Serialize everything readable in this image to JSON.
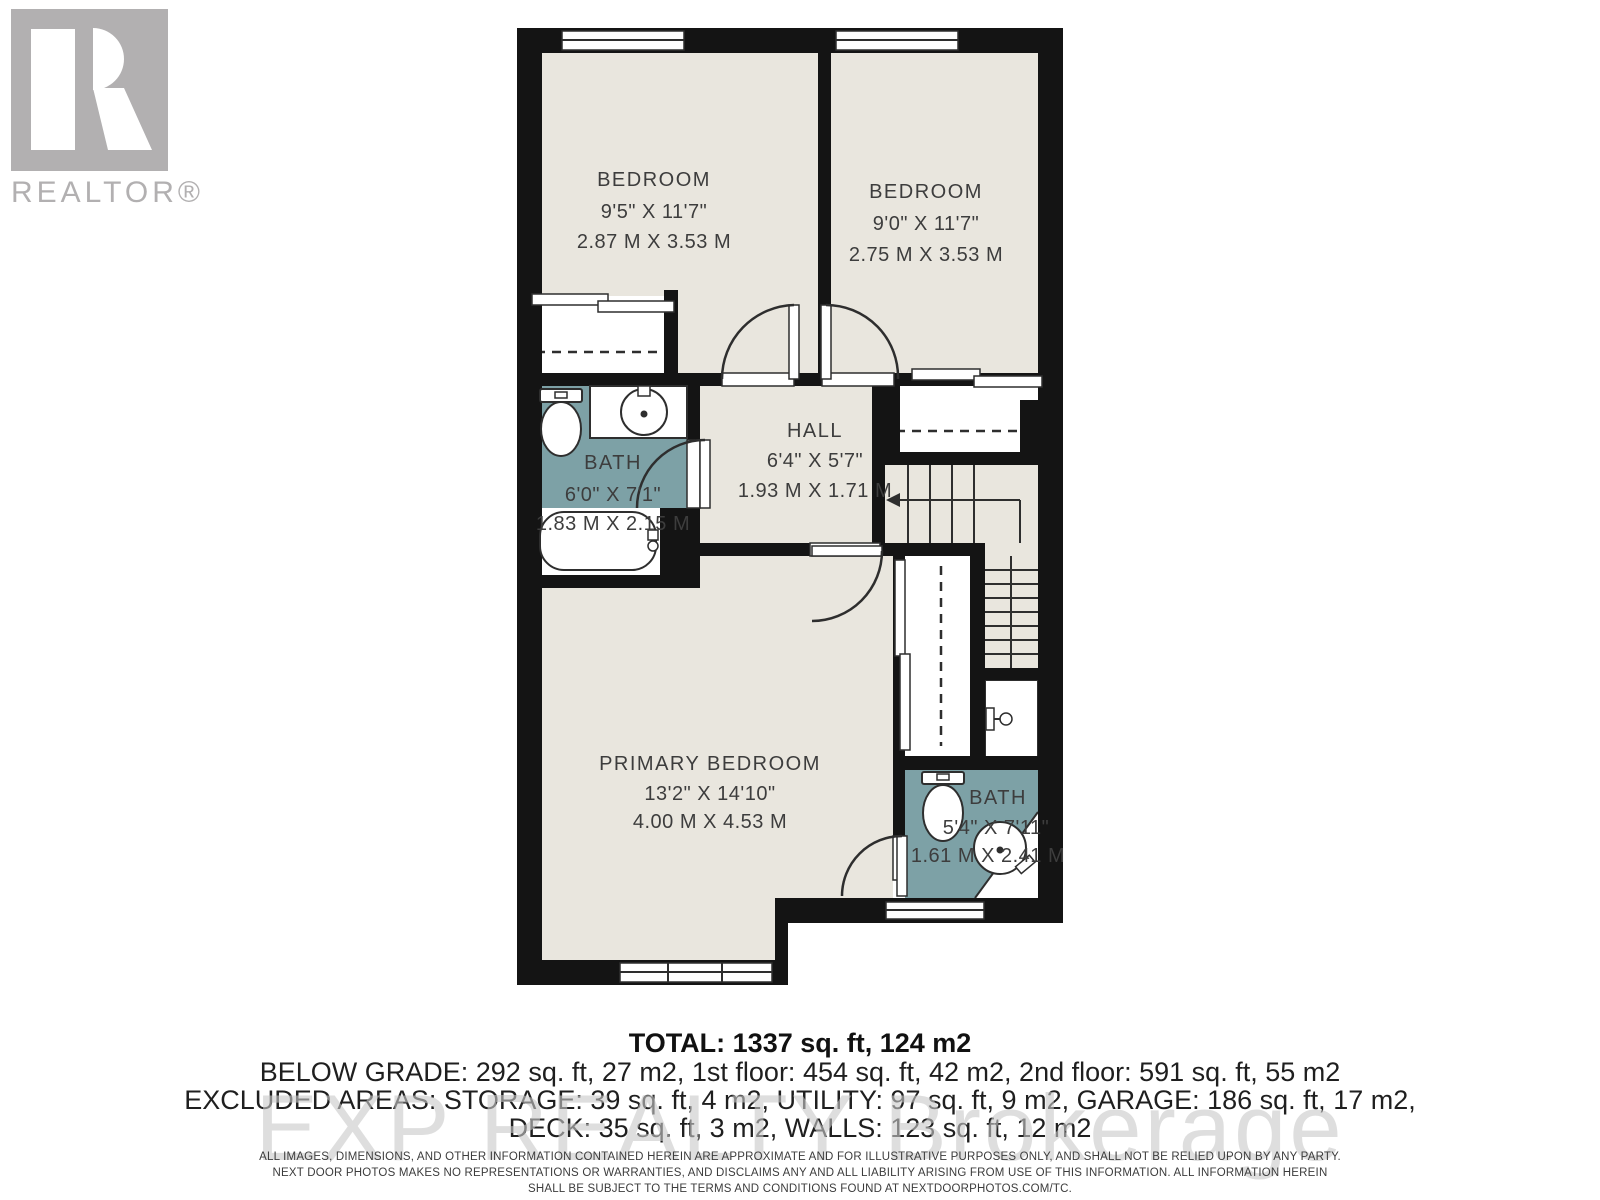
{
  "logo": {
    "symbol": "realtor-block-r",
    "wordmark": "REALTOR®"
  },
  "plan": {
    "rooms": {
      "bedroom1": {
        "name": "BEDROOM",
        "dims_imperial": "9'5\" X 11'7\"",
        "dims_metric": "2.87 M X 3.53 M"
      },
      "bedroom2": {
        "name": "BEDROOM",
        "dims_imperial": "9'0\" X 11'7\"",
        "dims_metric": "2.75 M X 3.53 M"
      },
      "hall": {
        "name": "HALL",
        "dims_imperial": "6'4\" X 5'7\"",
        "dims_metric": "1.93 M X 1.71 M"
      },
      "bath1": {
        "name": "BATH",
        "dims_imperial": "6'0\" X 7'1\"",
        "dims_metric": "1.83 M X 2.15 M"
      },
      "primary_bedroom": {
        "name": "PRIMARY BEDROOM",
        "dims_imperial": "13'2\" X 14'10\"",
        "dims_metric": "4.00 M X 4.53 M"
      },
      "bath2": {
        "name": "BATH",
        "dims_imperial": "5'4\" X 7'11\"",
        "dims_metric": "1.61 M X 2.41 M"
      }
    }
  },
  "summary": {
    "total": "TOTAL: 1337 sq. ft, 124 m2",
    "floors": "BELOW GRADE: 292 sq. ft, 27 m2, 1st floor: 454 sq. ft, 42 m2, 2nd floor: 591 sq. ft, 55 m2",
    "excluded": "EXCLUDED AREAS: STORAGE: 39 sq. ft, 4 m2, UTILITY: 97 sq. ft, 9 m2, GARAGE: 186 sq. ft, 17 m2,",
    "excluded2": "DECK: 35 sq. ft, 3 m2, WALLS: 123 sq. ft, 12 m2"
  },
  "watermark": "EXP REALTY Brokerage",
  "disclaimer": {
    "line1": "ALL IMAGES, DIMENSIONS, AND OTHER INFORMATION CONTAINED HEREIN ARE APPROXIMATE AND FOR ILLUSTRATIVE PURPOSES ONLY, AND SHALL NOT BE RELIED UPON BY ANY PARTY.",
    "line2": "NEXT DOOR PHOTOS MAKES NO REPRESENTATIONS OR WARRANTIES, AND DISCLAIMS ANY AND ALL LIABILITY ARISING FROM USE OF THIS INFORMATION. ALL INFORMATION HEREIN",
    "line3": "SHALL BE SUBJECT TO THE TERMS AND CONDITIONS FOUND AT NEXTDOORPHOTOS.COM/TC."
  },
  "colors": {
    "wall": "#141414",
    "floor": "#e9e6de",
    "bath_fill": "#7da1a6",
    "logo_gray": "#b2b0b1",
    "label": "#3d3d3d",
    "watermark_gray": "#c9c9c9"
  }
}
